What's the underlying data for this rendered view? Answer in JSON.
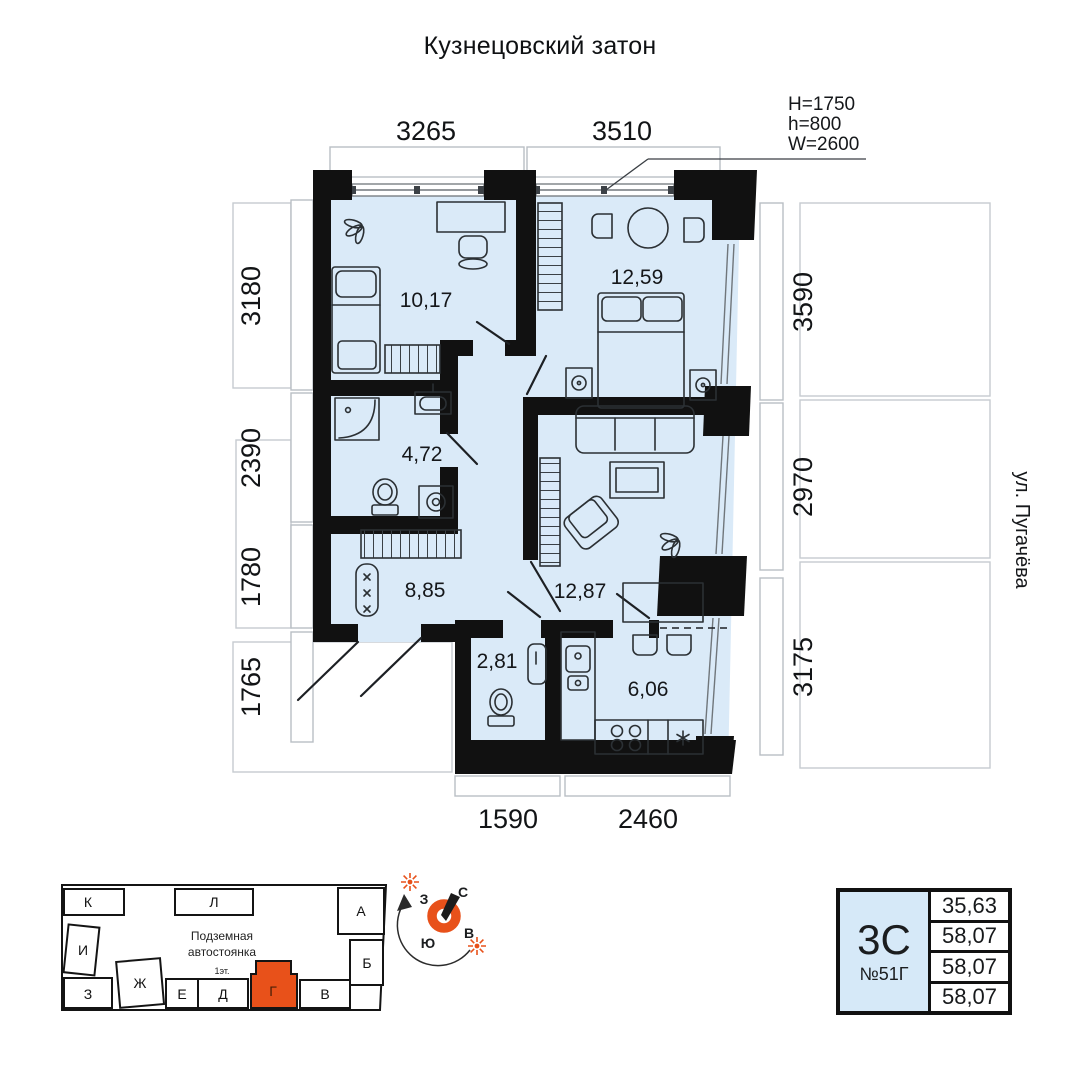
{
  "title": "Кузнецовский затон",
  "street_label": "ул. Пугачёва",
  "window_annotation": {
    "line1": "H=1750",
    "line2": "h=800",
    "line3": "W=2600"
  },
  "dimensions": {
    "top": [
      "3265",
      "3510"
    ],
    "left": [
      "3180",
      "2390",
      "1780",
      "1765"
    ],
    "right": [
      "3590",
      "2970",
      "3175"
    ],
    "bottom": [
      "1590",
      "2460"
    ]
  },
  "rooms": {
    "bedroom1_area": "10,17",
    "bedroom2_area": "12,59",
    "bathroom_area": "4,72",
    "hallway_area": "8,85",
    "living_area": "12,87",
    "wc_area": "2,81",
    "kitchen_area": "6,06"
  },
  "site_plan": {
    "parking_line1": "Подземная",
    "parking_line2": "автостоянка",
    "floor_label": "1эт.",
    "blocks": {
      "k": "К",
      "l": "Л",
      "a": "А",
      "i": "И",
      "b": "Б",
      "z": "З",
      "zh": "Ж",
      "e": "Е",
      "d": "Д",
      "g": "Г",
      "v": "В"
    }
  },
  "compass": {
    "north": "С",
    "south": "Ю",
    "west": "З",
    "east": "В"
  },
  "info_card": {
    "type": "3С",
    "number": "№51Г",
    "values": [
      "35,63",
      "58,07",
      "58,07",
      "58,07"
    ]
  },
  "colors": {
    "room_fill": "#daeaf8",
    "accent_orange": "#e8511a",
    "card_fill": "#d6e9f8",
    "wall": "#111111",
    "dim_border": "#b9bec4"
  }
}
